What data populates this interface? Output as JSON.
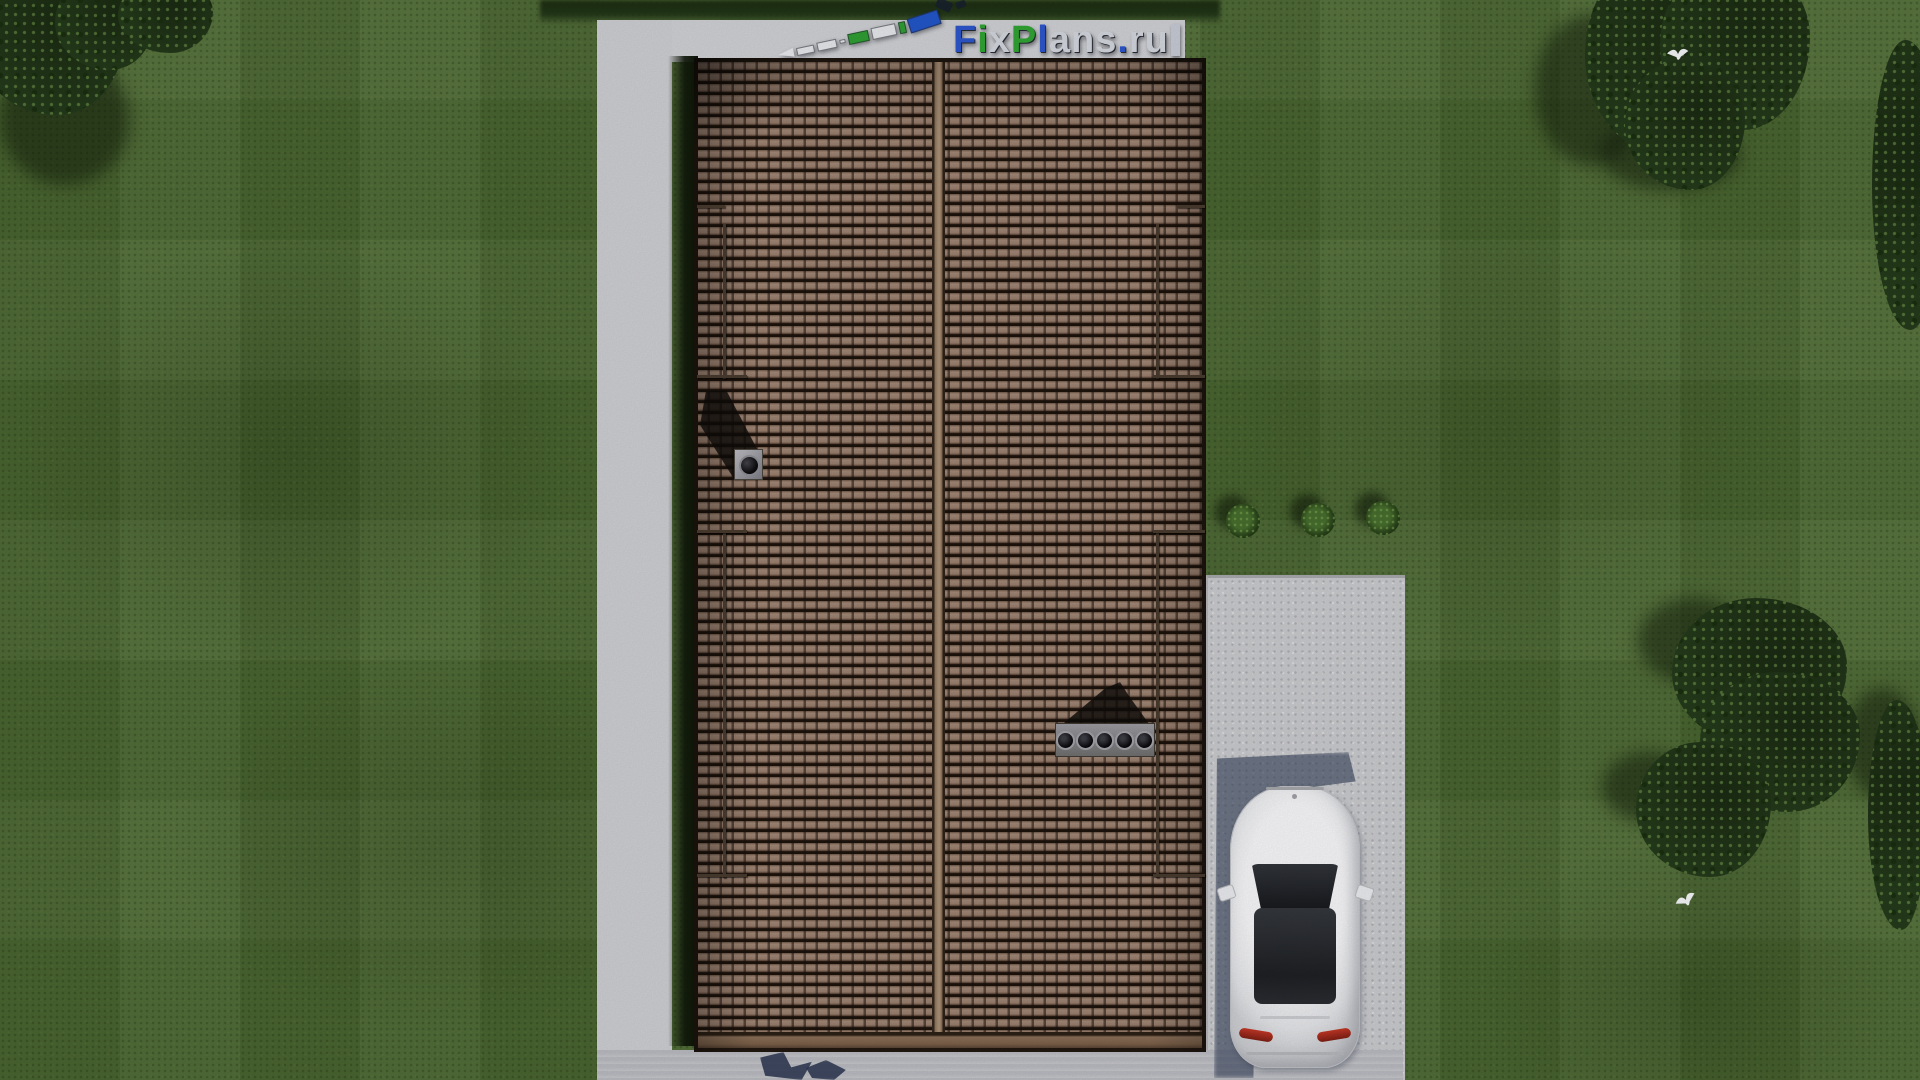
{
  "watermark": {
    "text": "FixPlans.ru",
    "runs": [
      {
        "t": "F",
        "color": "#2853cc"
      },
      {
        "t": "i",
        "color": "#2ba32e"
      },
      {
        "t": "x",
        "color": "#d4d7de"
      },
      {
        "t": "P",
        "color": "#2ba32e"
      },
      {
        "t": "l",
        "color": "#2853cc"
      },
      {
        "t": "ans",
        "color": "#d4d7de"
      },
      {
        "t": ".",
        "color": "#2853cc"
      },
      {
        "t": "ru",
        "color": "#d4d7de"
      }
    ]
  },
  "scene": {
    "view": "top-down aerial render of a house",
    "roof": {
      "tile_color_name": "brown",
      "ridge_orientation": "vertical",
      "chimney_count": 1,
      "vent_pipe_count": 5,
      "snow_rail_sections_per_side": 2
    },
    "vehicle": {
      "type": "car",
      "body_color_name": "white",
      "taillight_color_name": "red",
      "parked_on": "concrete driveway"
    },
    "landscape": {
      "bush_count": 3,
      "flying_bird_count": 2,
      "tree_cluster_count": 3
    },
    "hardscape": [
      "left concrete path",
      "top concrete patio",
      "right concrete driveway",
      "bottom concrete apron"
    ]
  },
  "colors": {
    "grass": "#4f6c34",
    "grass_shadow": "#17230f",
    "foliage": "#243a1a",
    "concrete_bright": "#cdced2",
    "concrete_shadow": "#848aa0",
    "roof_tile": "#977d6c",
    "roof_gap": "#1d130c",
    "roof_ridge": "#a88f76",
    "roof_fascia": "#8a6f58",
    "car_body": "#f7f7f9",
    "car_glass": "#1e2024",
    "taillight": "#c23726",
    "ruler_green": "#2f9e33",
    "ruler_blue": "#2356c8"
  }
}
